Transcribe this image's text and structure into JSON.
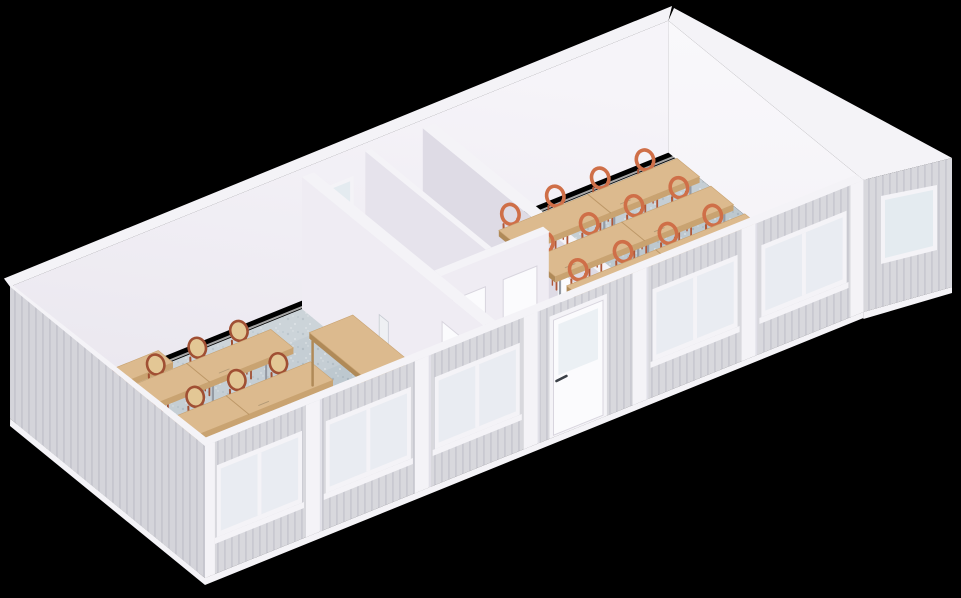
{
  "background": "#000000",
  "palette": {
    "cladding": "#d8d8dd",
    "cladding_rib": "#c9c9d1",
    "trim": "#f4f3f7",
    "trim_shadow": "#e1e0e8",
    "interior_back_wall_top": "#f6f4f9",
    "interior_back_wall_bottom": "#e9e6ee",
    "interior_wall_light": "#efecf3",
    "interior_wall_mid": "#e6e3ec",
    "interior_wall_dark": "#dedbe5",
    "east_wall_haze": "#f4f2f7",
    "utility_floor": "#eae8ee",
    "floor": "#bdc8cf",
    "floor_speck_dark": "#a9b5be",
    "floor_speck_light": "#d7dde1",
    "baseboard": "#ffffff",
    "wood_top": "#dcba8e",
    "wood_side": "#c9a371",
    "wood_dark": "#b08a58",
    "metal_leg": "#959ba4",
    "chair_orange": "#cf6f48",
    "chair_orange_dark": "#b05738",
    "chair_frame_red": "#a04f33",
    "chair_seat_pale": "#e3c795",
    "office_chair": "#eef0f3",
    "office_chair_shadow": "#c6cad1",
    "glass": "#dce5ec",
    "glass_opaque": "#e4ebf0",
    "door_leaf": "#fbfbfd",
    "door_outline": "#d8d5de",
    "handle": "#3a3f46"
  },
  "scene": {
    "subject": "isometric cutaway render of a modular classroom building",
    "left_classroom": {
      "double_table_rows": 2,
      "chairs_per_row": 4,
      "teacher_desks": 1,
      "office_chairs": 1,
      "wall_benches": 1
    },
    "center_utility": {
      "small_rooms": 2,
      "interior_doors": 4,
      "back_wall_windows": 1
    },
    "right_classroom": {
      "double_table_rows": 3,
      "chairs_per_row": 4
    },
    "facade": {
      "window_modules_left": 3,
      "window_modules_right": 2,
      "entrance_doors": 1,
      "gable_windows": 1
    }
  }
}
